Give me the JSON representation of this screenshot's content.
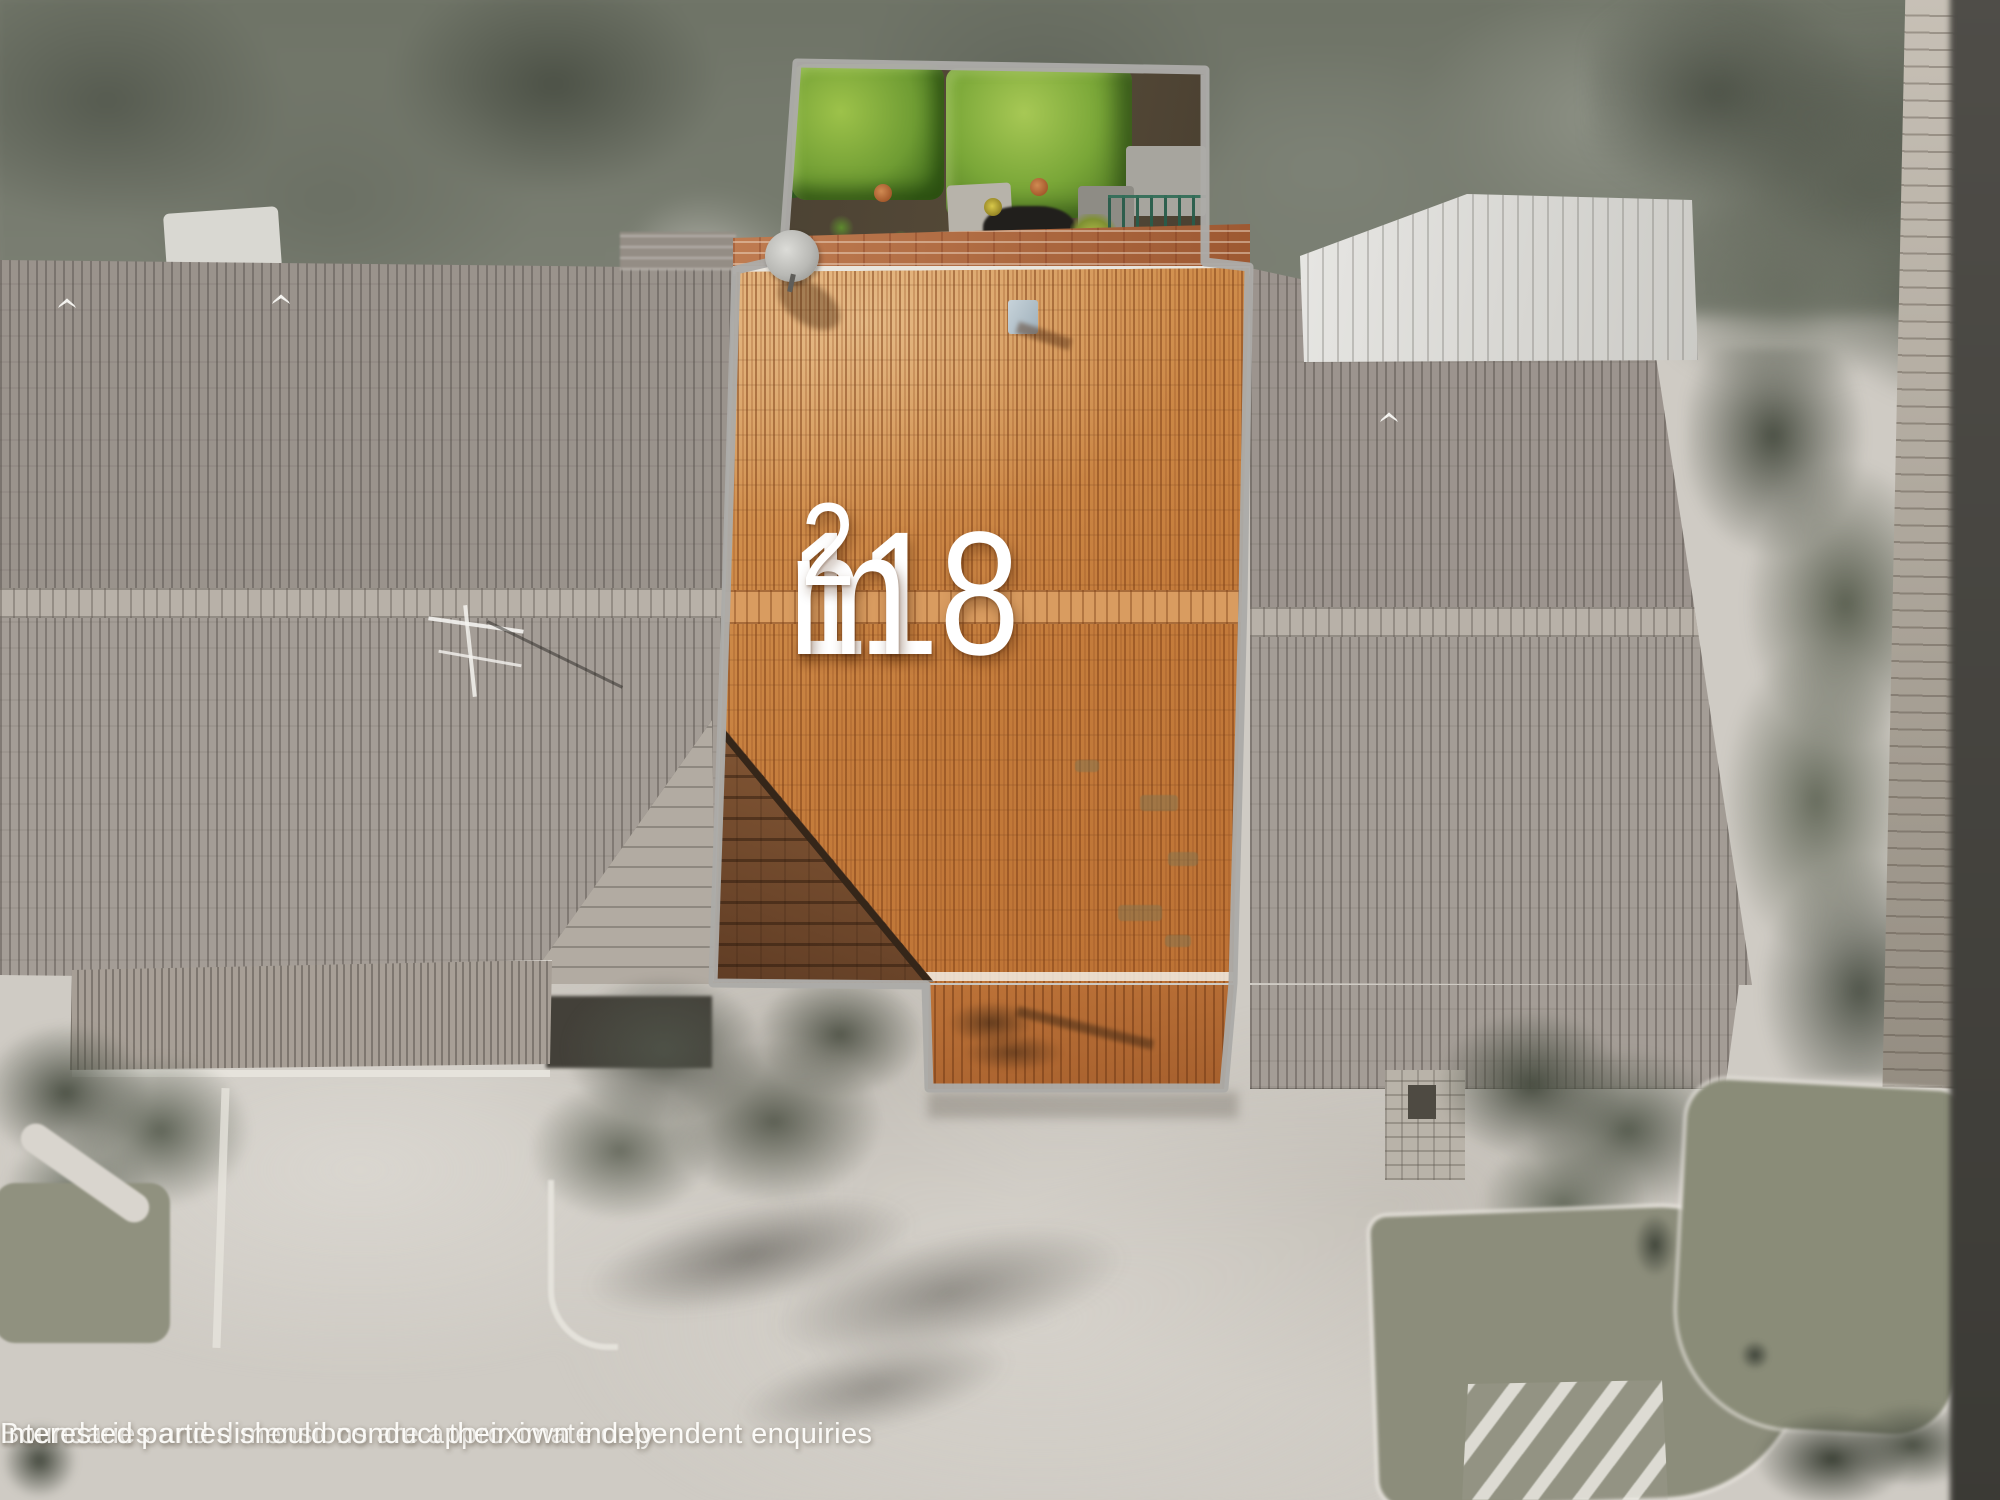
{
  "image": {
    "type": "aerial-property-highlight-photo",
    "area_label": {
      "number": "118",
      "unit": "m",
      "superscript": "2",
      "display": "118m²"
    },
    "disclaimer": {
      "line1": "Boundaries and dimensions are approximate only",
      "line2": "Interested parties should conduct their own independent enquiries"
    },
    "colors": {
      "boundary_outline": "#ACABA8",
      "highlight_roof": "#C57D3C",
      "hedge_green": "#6FA437",
      "label_text": "#FFFFFF",
      "pavement_gray": "#CFCBC4",
      "neighbour_roof_gray": "#A49D96"
    }
  }
}
